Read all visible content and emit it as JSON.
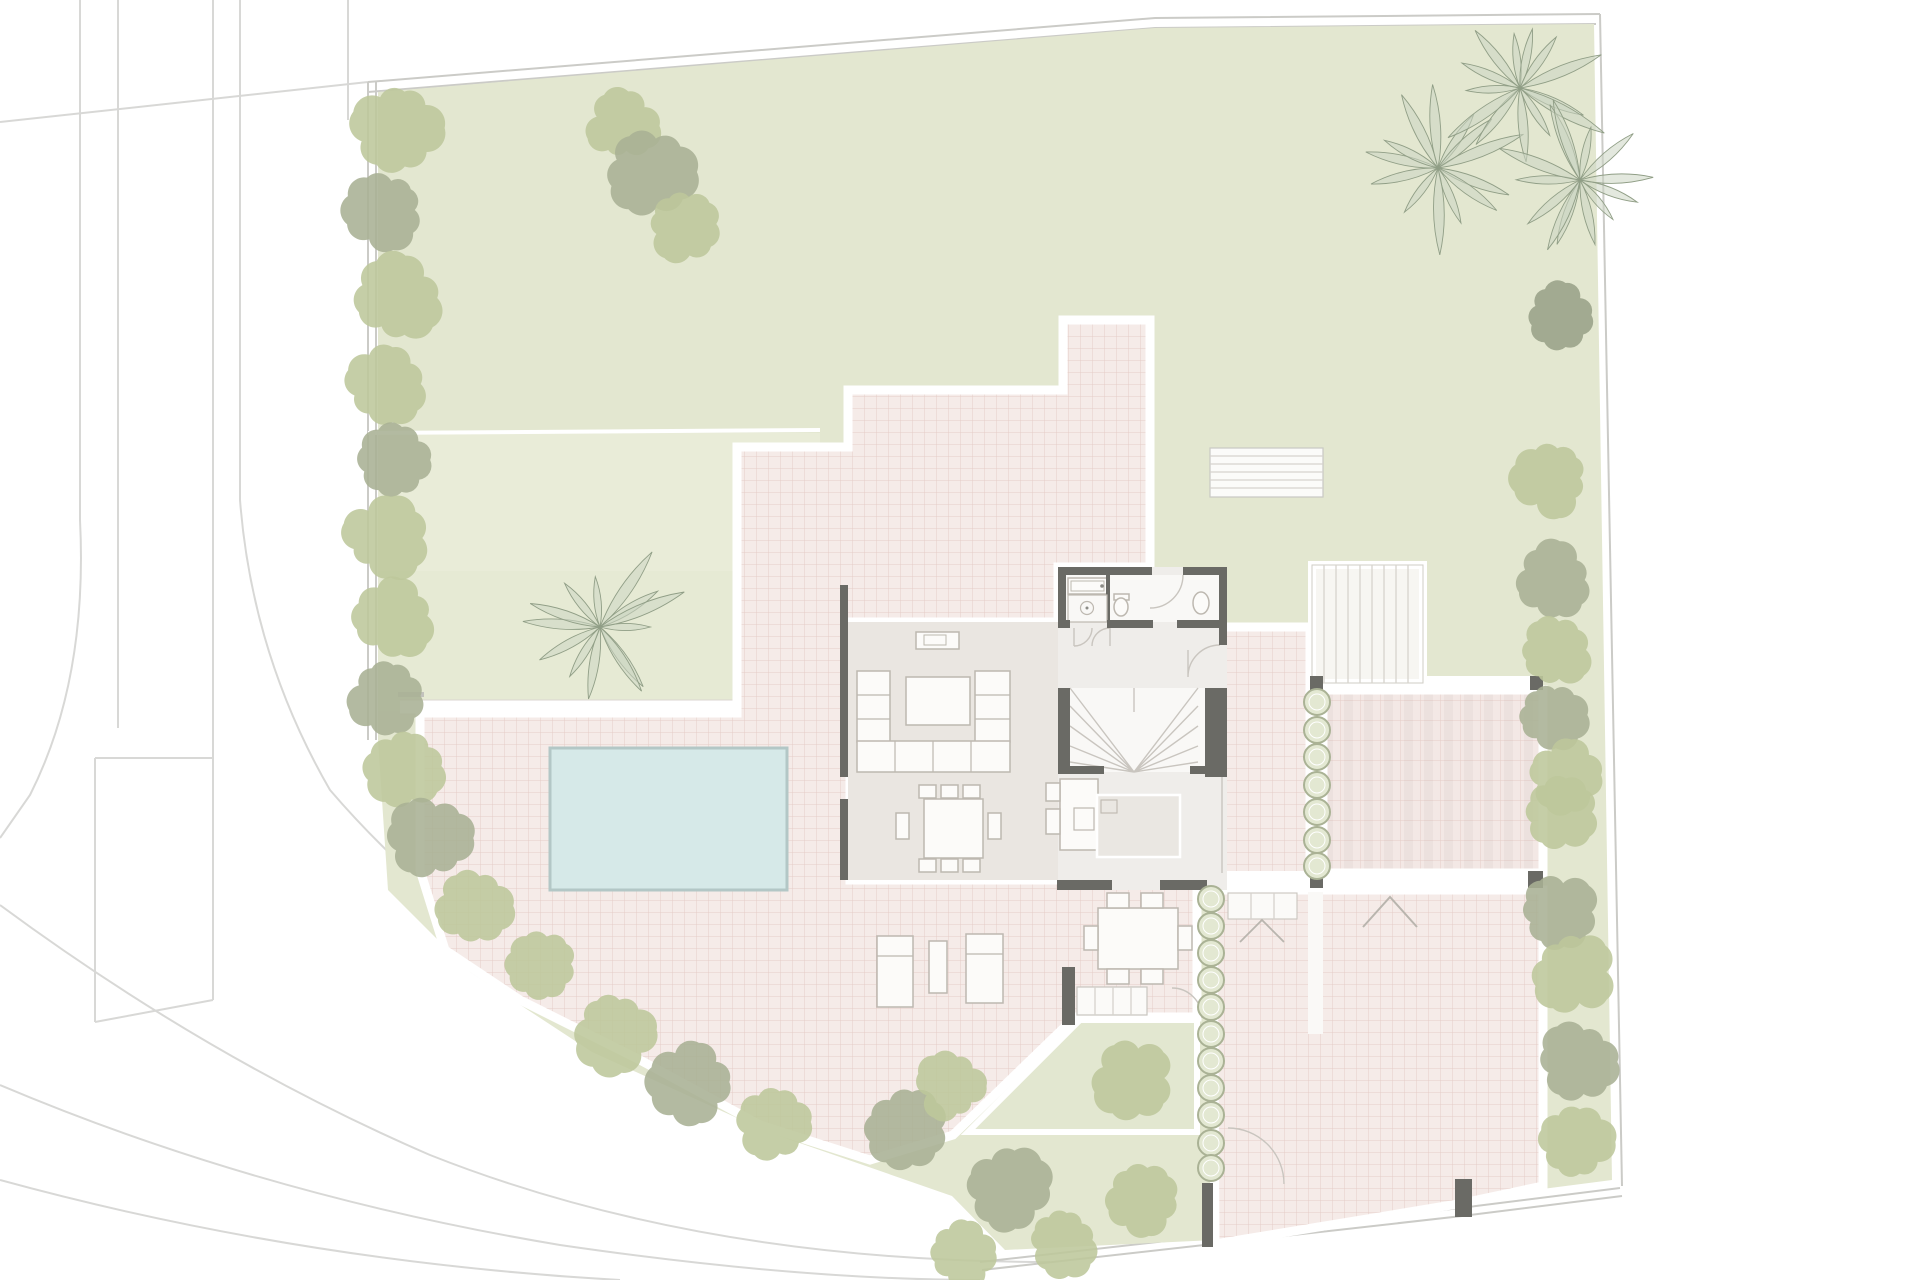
{
  "plan": {
    "kind": "residential-site-plan",
    "rooms": [
      "living-room",
      "dining-area",
      "kitchen",
      "bathroom",
      "hallway",
      "stairwell"
    ],
    "outdoor": [
      "pool",
      "pool-terrace",
      "upper-terrace",
      "east-terrace",
      "pergola-court",
      "driveway-court",
      "garden-bed",
      "lawn"
    ]
  },
  "colors": {
    "street-line": "#d8d8d6",
    "fence-line": "#cbcbc7",
    "lawn": "#e3e7d0",
    "lawn-upper": "#e1e6cd",
    "lawn-band": "#e9ecd8",
    "lawn-pool": "#e6ead4",
    "bed": "#e2e7d0",
    "paving": "#f5ebe8",
    "paving-line": "#e5cdc7",
    "pave-edge": "#dbd6d0",
    "stripe": "#8c827d",
    "pool-fill": "#d6e9e8",
    "pool-edge": "#b3c7c6",
    "wall": "#6a6a65",
    "floor": "#eae6e1",
    "floor-core": "#efedea",
    "floor-white": "#f9f8f6",
    "furniture-fill": "#fcfbf9",
    "furniture-line": "#bdb8b0",
    "hairline": "#c9c5bf",
    "step-line": "#d6d3cd",
    "tree-light": "#bdc79b",
    "tree-gray": "#a8b194",
    "tree-dark": "#99a287",
    "bush-fill": "#e3e8d2",
    "bush-line": "#aab295",
    "palm-fill": "#ccd5c2",
    "palm-line": "#909e86"
  },
  "landscape": {
    "trees": [
      [
        398,
        128,
        46,
        "l"
      ],
      [
        386,
        210,
        40,
        "g"
      ],
      [
        398,
        298,
        44,
        "l"
      ],
      [
        386,
        384,
        42,
        "l"
      ],
      [
        396,
        460,
        40,
        "g"
      ],
      [
        384,
        538,
        42,
        "l"
      ],
      [
        394,
        616,
        44,
        "l"
      ],
      [
        388,
        696,
        40,
        "g"
      ],
      [
        406,
        766,
        40,
        "l"
      ],
      [
        430,
        838,
        42,
        "g"
      ],
      [
        474,
        906,
        40,
        "l"
      ],
      [
        542,
        964,
        38,
        "l"
      ],
      [
        622,
        126,
        36,
        "l"
      ],
      [
        650,
        172,
        48,
        "g"
      ],
      [
        684,
        224,
        38,
        "l"
      ],
      [
        614,
        1030,
        42,
        "l"
      ],
      [
        692,
        1082,
        44,
        "g"
      ],
      [
        774,
        1122,
        40,
        "l"
      ],
      [
        906,
        1128,
        44,
        "g"
      ],
      [
        952,
        1086,
        36,
        "l"
      ],
      [
        1008,
        1188,
        46,
        "g"
      ],
      [
        962,
        1252,
        36,
        "l"
      ],
      [
        1062,
        1240,
        36,
        "l"
      ],
      [
        1133,
        1078,
        42,
        "l"
      ],
      [
        1142,
        1198,
        40,
        "l"
      ],
      [
        1560,
        315,
        36,
        "d"
      ],
      [
        1552,
        478,
        40,
        "l"
      ],
      [
        1553,
        580,
        42,
        "g"
      ],
      [
        1554,
        650,
        38,
        "l"
      ],
      [
        1550,
        715,
        36,
        "g"
      ],
      [
        1565,
        775,
        38,
        "l"
      ],
      [
        1560,
        812,
        40,
        "l"
      ],
      [
        1558,
        912,
        40,
        "g"
      ],
      [
        1574,
        972,
        42,
        "l"
      ],
      [
        1578,
        1062,
        44,
        "g"
      ],
      [
        1574,
        1142,
        40,
        "l"
      ]
    ],
    "palms": [
      [
        600,
        627,
        92
      ],
      [
        1438,
        168,
        95
      ],
      [
        1520,
        88,
        98
      ],
      [
        1580,
        180,
        88
      ]
    ],
    "bush_rows": [
      {
        "x": 1317,
        "r": 13,
        "ys": [
          702,
          730,
          757,
          785,
          812,
          840,
          866
        ]
      },
      {
        "x": 1211,
        "r": 13,
        "ys": [
          899,
          926,
          953,
          980,
          1007,
          1034,
          1061,
          1088,
          1115,
          1143,
          1168
        ]
      }
    ]
  }
}
